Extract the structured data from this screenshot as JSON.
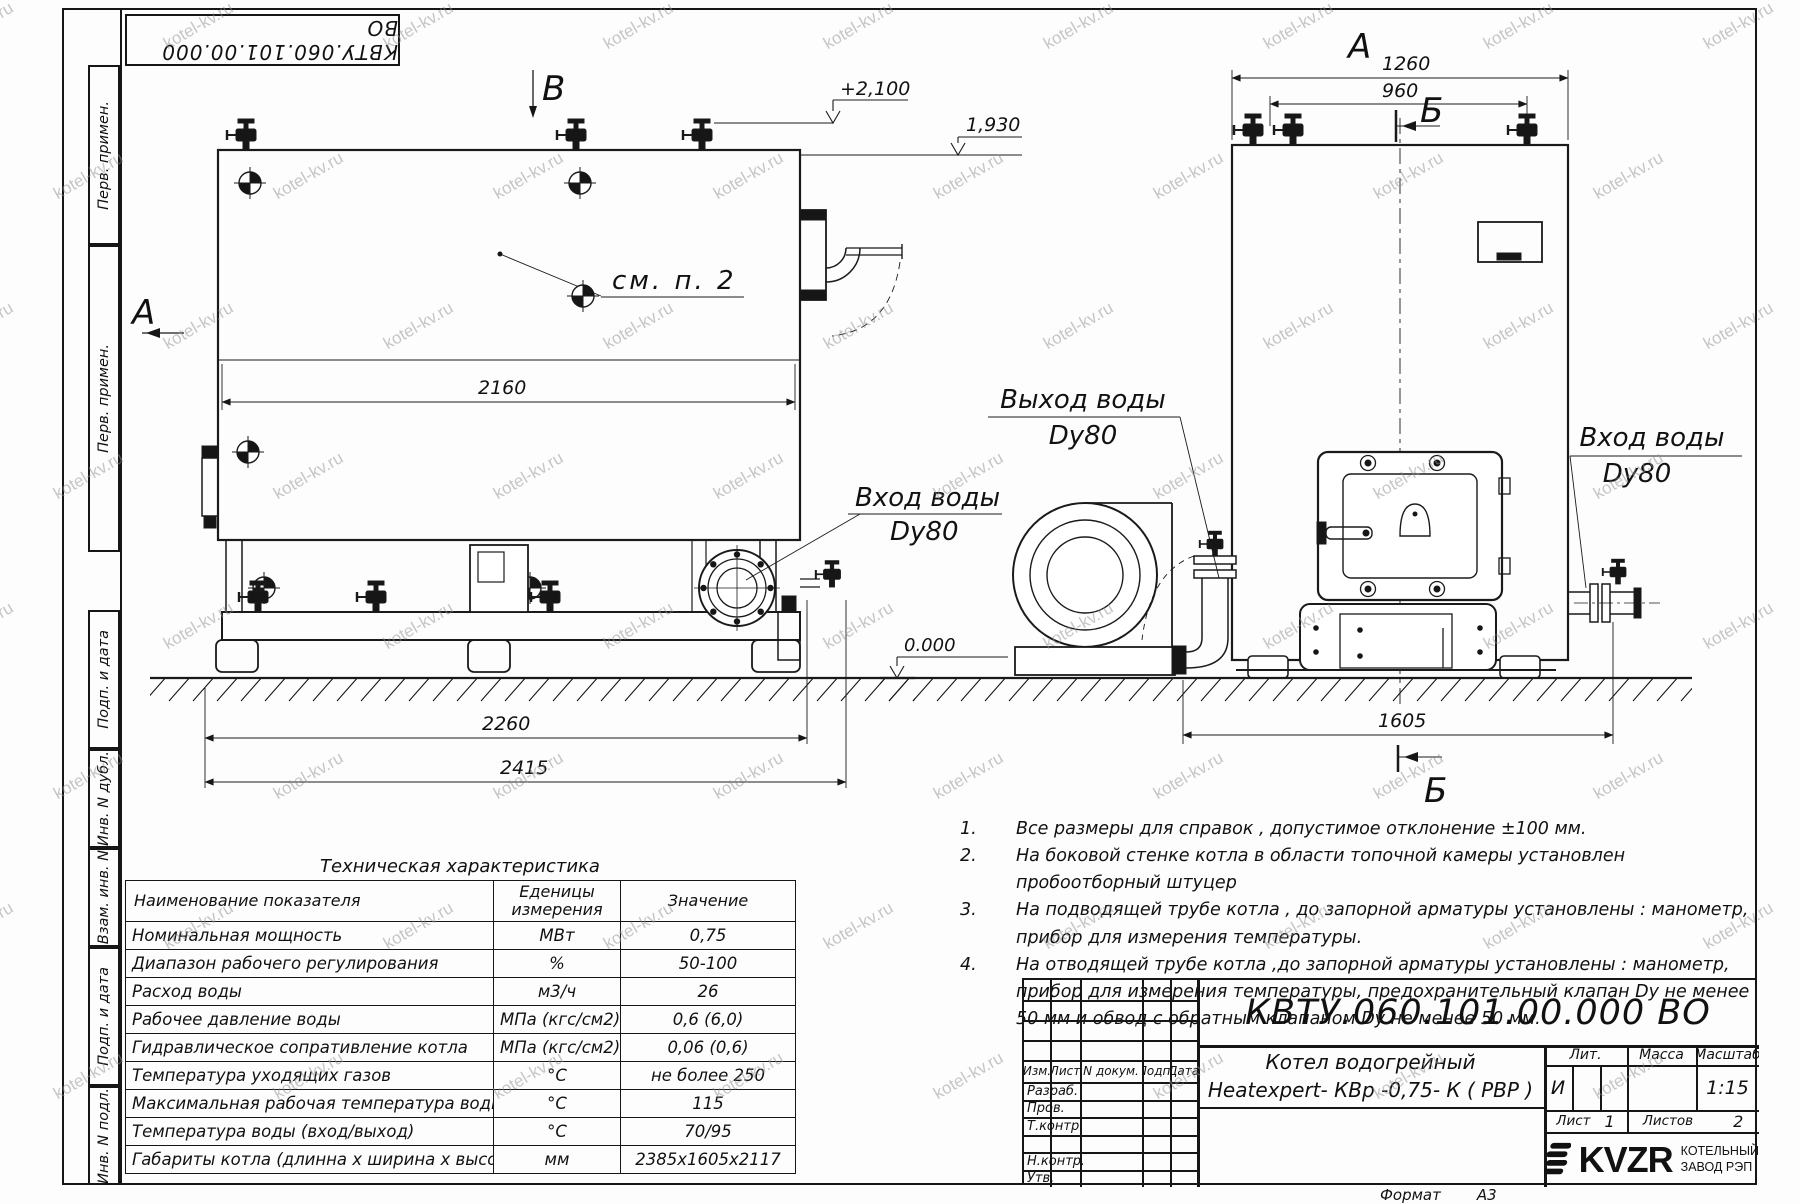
{
  "watermark": {
    "text": "kotel-kv.ru"
  },
  "stamp_top": "КВТУ.060.101.00.000  ВО",
  "side_strips": {
    "top": [
      "Перв. примен.",
      "Перв. примен."
    ],
    "bottom": [
      "Подп. и дата",
      "Инв. N дубл.",
      "Взам. инв. N",
      "Подп. и дата",
      "Инв. N подл."
    ]
  },
  "drawing": {
    "left_view": {
      "label_a": "А",
      "label_b": "В",
      "callout": "см. п. 2",
      "level_top": "+2,100",
      "level_mid": "1,930",
      "level_zero": "0.000",
      "dim_width": "2160",
      "dim_base": "2260",
      "dim_total": "2415",
      "inlet_line1": "Вход воды",
      "inlet_line2": "Dy80"
    },
    "right_view": {
      "label_a": "А",
      "label_b_top": "Б",
      "label_b_bottom": "Б",
      "dim_top": "1260",
      "dim_valves": "960",
      "dim_base": "1605",
      "outlet_line1": "Выход воды",
      "outlet_line2": "Dy80",
      "inlet_line1": "Вход воды",
      "inlet_line2": "Dy80"
    }
  },
  "table": {
    "title": "Техническая характеристика",
    "headers": [
      "Наименование показателя",
      "Еденицы измерения",
      "Значение"
    ],
    "rows": [
      {
        "name": "Номинальная мощность",
        "unit": "МВт",
        "value": "0,75"
      },
      {
        "name": "Диапазон рабочего регулирования",
        "unit": "%",
        "value": "50-100"
      },
      {
        "name": "Расход воды",
        "unit": "м3/ч",
        "value": "26"
      },
      {
        "name": "Рабочее давление воды",
        "unit": "МПа (кгс/см2)",
        "value": "0,6 (6,0)"
      },
      {
        "name": "Гидравлическое сопративление котла",
        "unit": "МПа (кгс/см2)",
        "value": "0,06 (0,6)"
      },
      {
        "name": "Температура уходящих газов",
        "unit": "°С",
        "value": "не более 250"
      },
      {
        "name": "Максимальная рабочая температура воды",
        "unit": "°С",
        "value": "115"
      },
      {
        "name": "Температура воды (вход/выход)",
        "unit": "°С",
        "value": "70/95"
      },
      {
        "name": "Габариты котла (длинна х ширина х высота)",
        "unit": "мм",
        "value": "2385х1605х2117"
      }
    ]
  },
  "notes": [
    {
      "n": "1.",
      "t": "Все размеры для справок , допустимое отклонение  ±100 мм."
    },
    {
      "n": "2.",
      "t": "На боковой стенке котла в области топочной камеры установлен пробоотборный штуцер"
    },
    {
      "n": "3.",
      "t": "На  подводящей трубе котла , до запорной арматуры установлены : манометр, прибор для измерения температуры."
    },
    {
      "n": "4.",
      "t": "На отводящей трубе котла ,до запорной арматуры установлены : манометр, прибор для измерения температуры, предохранительный клапан  Dу не менее  50 мм и обвод с обратным клапаном  Dу не менее  50 мм."
    }
  ],
  "title_block": {
    "doc_number": "КВТУ.060.101.00.000  ВО",
    "header_cells": [
      "Изм.",
      "Лист",
      "N докум.",
      "Подп.",
      "Дата"
    ],
    "row_labels": [
      "Разраб.",
      "Пров.",
      "Т.контр.",
      "Н.контр.",
      "Утв."
    ],
    "product_name_1": "Котел водогрейный",
    "product_name_2": "Heatexpert- КВр -0,75- К ( РВР )",
    "lit_label": "Лит.",
    "lit_value": "И",
    "mass_label": "Масса",
    "scale_label": "Масштаб",
    "scale_value": "1:15",
    "sheet_label": "Лист",
    "sheet_value": "1",
    "sheets_label": "Листов",
    "sheets_value": "2",
    "company_logo": "KVZR",
    "company_name_1": "КОТЕЛЬНЫЙ",
    "company_name_2": "ЗАВОД РЭП",
    "format_label": "Формат",
    "format_value": "А3"
  }
}
